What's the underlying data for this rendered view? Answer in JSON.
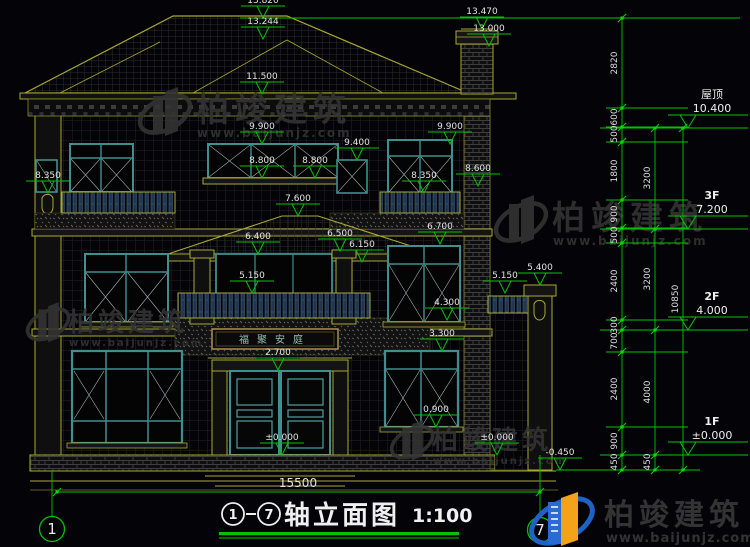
{
  "title": {
    "axis_start": "1",
    "axis_end": "7",
    "name": "轴立面图",
    "scale": "1:100"
  },
  "watermark": {
    "brand": "柏竣建筑",
    "url": "www.baijunjz.com"
  },
  "plaque": {
    "text": "福聚安庭"
  },
  "colors": {
    "dim_green": "#00c300",
    "line_yellow": "#a8a832",
    "sash_teal": "#3f8f8f",
    "text_white": "#e2e2e2",
    "logo_blue": "#1f62c5",
    "logo_orange": "#f5a21b"
  },
  "drawing": {
    "levels": [
      {
        "value": "13.820",
        "x": 263,
        "y": 18
      },
      {
        "value": "13.244",
        "x": 263,
        "y": 39
      },
      {
        "value": "13.470",
        "x": 482,
        "y": 29
      },
      {
        "value": "13.000",
        "x": 489,
        "y": 46
      },
      {
        "value": "11.500",
        "x": 262,
        "y": 94
      },
      {
        "value": "9.900",
        "x": 262,
        "y": 144
      },
      {
        "value": "9.900",
        "x": 450,
        "y": 144
      },
      {
        "value": "9.400",
        "x": 357,
        "y": 160
      },
      {
        "value": "8.800",
        "x": 262,
        "y": 178
      },
      {
        "value": "8.800",
        "x": 315,
        "y": 178
      },
      {
        "value": "8.350",
        "x": 48,
        "y": 193
      },
      {
        "value": "8.350",
        "x": 424,
        "y": 193
      },
      {
        "value": "8.600",
        "x": 478,
        "y": 186
      },
      {
        "value": "7.600",
        "x": 298,
        "y": 216
      },
      {
        "value": "6.400",
        "x": 258,
        "y": 254
      },
      {
        "value": "6.500",
        "x": 340,
        "y": 251
      },
      {
        "value": "6.150",
        "x": 362,
        "y": 262
      },
      {
        "value": "6.700",
        "x": 440,
        "y": 244
      },
      {
        "value": "5.150",
        "x": 252,
        "y": 293
      },
      {
        "value": "5.150",
        "x": 505,
        "y": 293
      },
      {
        "value": "5.400",
        "x": 540,
        "y": 285
      },
      {
        "value": "4.300",
        "x": 447,
        "y": 320
      },
      {
        "value": "3.300",
        "x": 442,
        "y": 351
      },
      {
        "value": "2.700",
        "x": 278,
        "y": 370
      },
      {
        "value": "0.900",
        "x": 436,
        "y": 427
      },
      {
        "value": "±0.000",
        "x": 282,
        "y": 455
      },
      {
        "value": "±0.000",
        "x": 497,
        "y": 455
      },
      {
        "value": "-0.450",
        "x": 560,
        "y": 470
      }
    ],
    "floor_markers": [
      {
        "label": "屋顶",
        "value": "10.400",
        "y": 128,
        "bold": false
      },
      {
        "label": "3F",
        "value": "7.200",
        "y": 229,
        "bold": true
      },
      {
        "label": "2F",
        "value": "4.000",
        "y": 330,
        "bold": true
      },
      {
        "label": "1F",
        "value": "±0.000",
        "y": 455,
        "bold": true
      }
    ],
    "chains": [
      {
        "x": 622,
        "ticks": [
          18,
          108,
          127,
          142,
          200,
          228,
          243,
          320,
          330,
          352,
          427,
          455,
          470
        ],
        "labels": [
          [
            "2820",
            63
          ],
          [
            "600",
            117
          ],
          [
            "500",
            134
          ],
          [
            "1800",
            171
          ],
          [
            "900",
            214
          ],
          [
            "500",
            235
          ],
          [
            "2400",
            281
          ],
          [
            "300",
            325
          ],
          [
            "700",
            341
          ],
          [
            "2400",
            389
          ],
          [
            "900",
            441
          ],
          [
            "450",
            462
          ]
        ]
      },
      {
        "x": 655,
        "ticks": [
          128,
          229,
          330,
          455,
          470
        ],
        "labels": [
          [
            "3200",
            178
          ],
          [
            "3200",
            279
          ],
          [
            "4000",
            392
          ],
          [
            "450",
            462
          ]
        ]
      },
      {
        "x": 683,
        "ticks": [
          128,
          470
        ],
        "labels": [
          [
            "10850",
            299
          ]
        ]
      }
    ],
    "connectors": [
      {
        "y": 18,
        "x1": 240,
        "x2": 740
      },
      {
        "y": 128,
        "x1": 600,
        "x2": 748
      },
      {
        "y": 229,
        "x1": 600,
        "x2": 748
      },
      {
        "y": 330,
        "x1": 600,
        "x2": 748
      },
      {
        "y": 455,
        "x1": 600,
        "x2": 748
      },
      {
        "y": 470,
        "x1": 556,
        "x2": 700
      },
      {
        "y": 108,
        "x1": 606,
        "x2": 688
      },
      {
        "y": 127,
        "x1": 606,
        "x2": 688
      },
      {
        "y": 142,
        "x1": 606,
        "x2": 688
      },
      {
        "y": 200,
        "x1": 606,
        "x2": 688
      },
      {
        "y": 228,
        "x1": 606,
        "x2": 688
      },
      {
        "y": 243,
        "x1": 606,
        "x2": 688
      },
      {
        "y": 320,
        "x1": 606,
        "x2": 688
      },
      {
        "y": 352,
        "x1": 606,
        "x2": 688
      },
      {
        "y": 427,
        "x1": 606,
        "x2": 688
      }
    ],
    "bottom_dim": {
      "label": "15500",
      "y": 492,
      "x1": 57,
      "x2": 540,
      "lx": 298,
      "ly": 487
    }
  }
}
